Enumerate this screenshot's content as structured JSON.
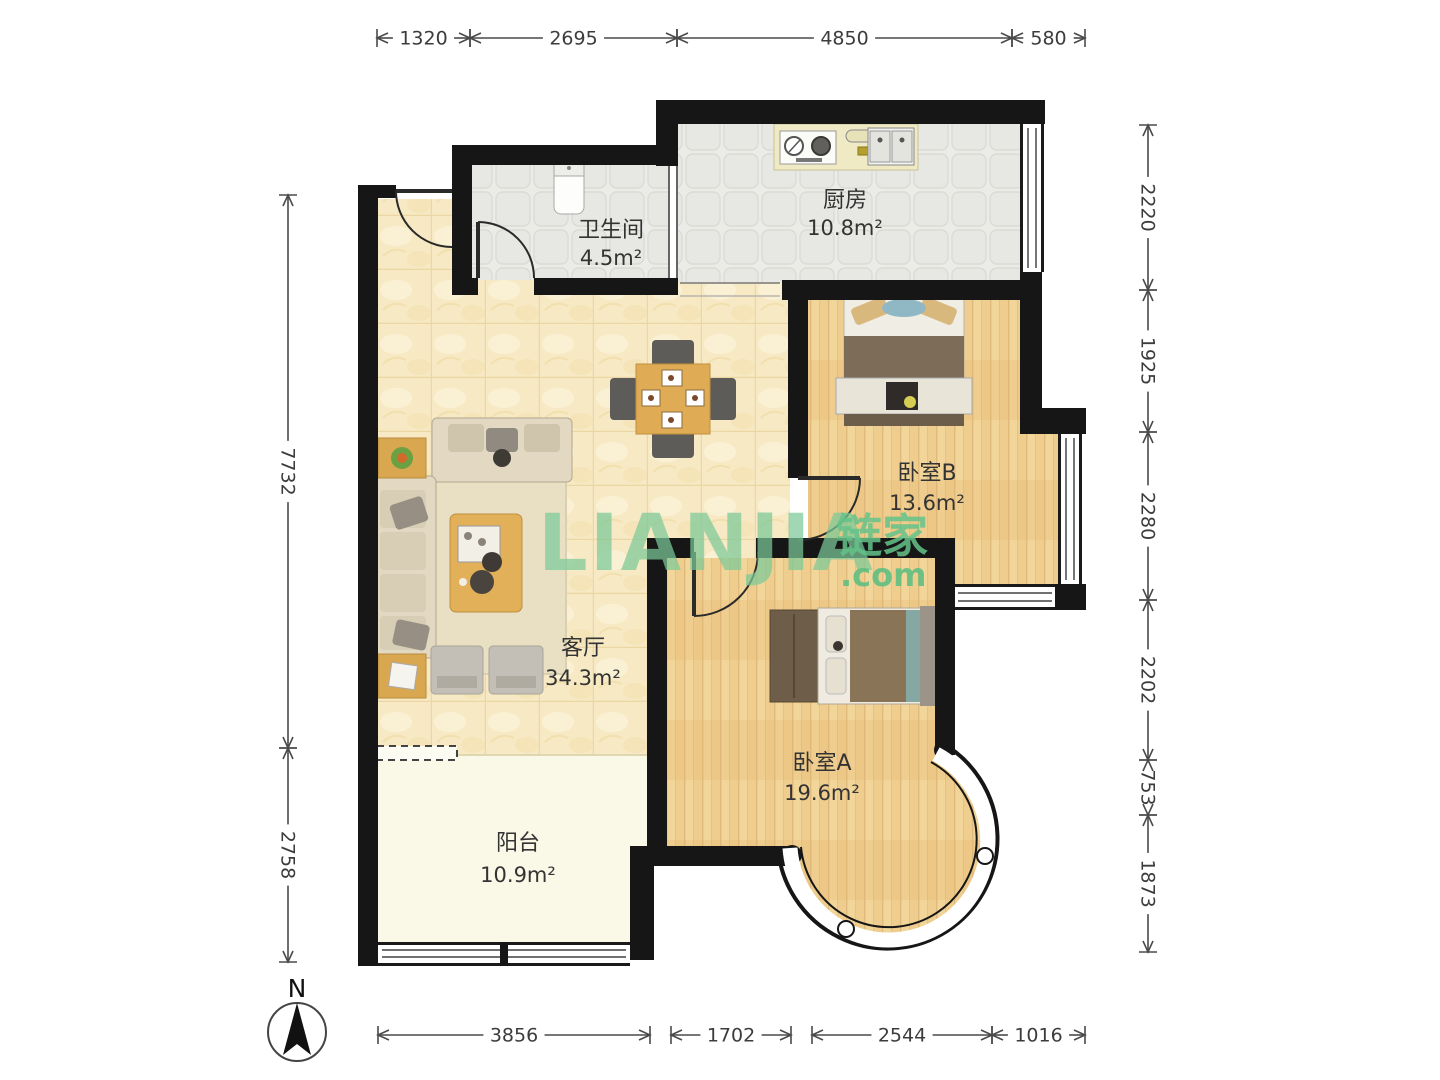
{
  "watermark": {
    "brand": "LIANJIA",
    "brand_cn": "链家",
    "suffix": ".com",
    "color": "#7cc998"
  },
  "compass": {
    "north_label": "N"
  },
  "rooms": [
    {
      "name": "卫生间",
      "area": "4.5m²"
    },
    {
      "name": "厨房",
      "area": "10.8m²"
    },
    {
      "name": "卧室B",
      "area": "13.6m²"
    },
    {
      "name": "客厅",
      "area": "34.3m²"
    },
    {
      "name": "卧室A",
      "area": "19.6m²"
    },
    {
      "name": "阳台",
      "area": "10.9m²"
    }
  ],
  "dimensions_mm": {
    "top": [
      "1320",
      "2695",
      "4850",
      "580"
    ],
    "right": [
      "2220",
      "1925",
      "2280",
      "2202",
      "753",
      "1873"
    ],
    "left": [
      "7732",
      "2758"
    ],
    "bottom": [
      "3856",
      "1702",
      "2544",
      "1016"
    ]
  },
  "colors": {
    "wall": "#161616",
    "floor_wood": "#efcd8e",
    "floor_marble": "#f7e9c3",
    "floor_tile": "#ebebe8",
    "floor_balcony": "#faf8e6",
    "watermark_green": "#7cc998",
    "dimension_text": "#3c3c3c",
    "label_text": "#333333"
  }
}
